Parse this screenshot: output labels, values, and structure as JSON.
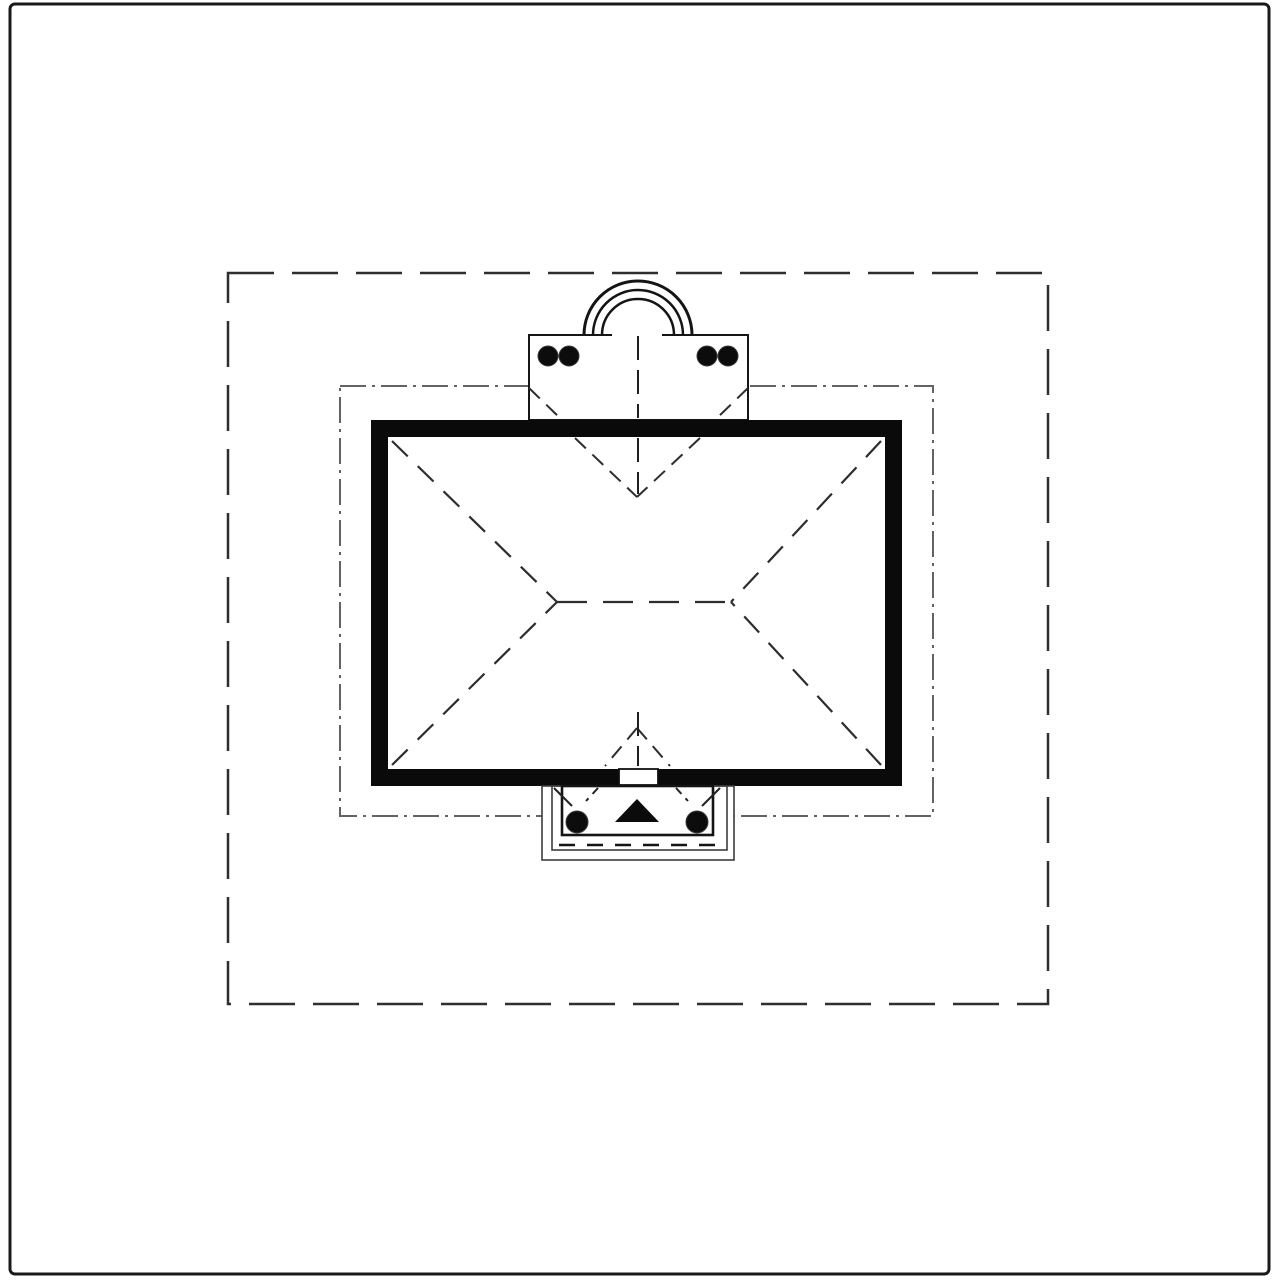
{
  "drawing": {
    "width": 1280,
    "height": 1280,
    "background": "#ffffff",
    "palette": {
      "ink": "#0a0a0a",
      "line_dark": "#1a1a1a",
      "roofline_gray": "#2d2d2d",
      "setback_gray": "#636363",
      "boundary_gray": "#2e2e2e",
      "white": "#ffffff"
    },
    "shapes": [
      {
        "name": "page-border",
        "type": "rect",
        "attrs": {
          "x": 10,
          "y": 4,
          "width": 1259,
          "height": 1270,
          "rx": 5,
          "fill": "none",
          "stroke": "#1a1a1a",
          "stroke-width": 3
        }
      },
      {
        "name": "property-boundary-dashed",
        "type": "rect",
        "attrs": {
          "x": 228,
          "y": 273,
          "width": 820,
          "height": 731,
          "fill": "none",
          "stroke": "#2e2e2e",
          "stroke-width": 2.5,
          "stroke-dasharray": "46 18"
        }
      },
      {
        "name": "setback-line-dashed",
        "type": "rect",
        "attrs": {
          "x": 340,
          "y": 386,
          "width": 593,
          "height": 430,
          "fill": "none",
          "stroke": "#636363",
          "stroke-width": 2,
          "stroke-dasharray": "26 6 3 6"
        }
      },
      {
        "name": "portico-slab",
        "type": "rect",
        "attrs": {
          "x": 529,
          "y": 335,
          "width": 219,
          "height": 85,
          "fill": "#ffffff",
          "stroke": "#161616",
          "stroke-width": 2
        }
      },
      {
        "name": "portico-entry-gap",
        "type": "rect",
        "attrs": {
          "x": 612,
          "y": 331,
          "width": 50,
          "height": 8,
          "fill": "#ffffff",
          "stroke": "none"
        }
      },
      {
        "name": "portico-arch-outer-icon",
        "type": "path",
        "attrs": {
          "d": "M 584 335 A 54 54 0 0 1 692 335",
          "fill": "none",
          "stroke": "#141414",
          "stroke-width": 3
        }
      },
      {
        "name": "portico-arch-middle-icon",
        "type": "path",
        "attrs": {
          "d": "M 593 335 A 45 45 0 0 1 683 335",
          "fill": "none",
          "stroke": "#141414",
          "stroke-width": 2.5
        }
      },
      {
        "name": "portico-arch-inner-icon",
        "type": "path",
        "attrs": {
          "d": "M 602 335 A 36 36 0 0 1 674 335",
          "fill": "none",
          "stroke": "#141414",
          "stroke-width": 2.5
        }
      },
      {
        "name": "portico-column-1",
        "type": "circle",
        "attrs": {
          "cx": 548,
          "cy": 356,
          "r": 10,
          "fill": "#0c0c0c",
          "stroke": "#3a3a3a",
          "stroke-width": 1
        }
      },
      {
        "name": "portico-column-2",
        "type": "circle",
        "attrs": {
          "cx": 569,
          "cy": 356,
          "r": 10,
          "fill": "#0c0c0c",
          "stroke": "#3a3a3a",
          "stroke-width": 1
        }
      },
      {
        "name": "portico-column-3",
        "type": "circle",
        "attrs": {
          "cx": 707,
          "cy": 356,
          "r": 10,
          "fill": "#0c0c0c",
          "stroke": "#3a3a3a",
          "stroke-width": 1
        }
      },
      {
        "name": "portico-column-4",
        "type": "circle",
        "attrs": {
          "cx": 728,
          "cy": 356,
          "r": 10,
          "fill": "#0c0c0c",
          "stroke": "#3a3a3a",
          "stroke-width": 1
        }
      },
      {
        "name": "building-wall",
        "type": "rect",
        "attrs": {
          "x": 371,
          "y": 420,
          "width": 531,
          "height": 366,
          "fill": "#0a0a0a"
        }
      },
      {
        "name": "roof-plane",
        "type": "rect",
        "attrs": {
          "x": 388,
          "y": 437,
          "width": 497,
          "height": 332,
          "fill": "#ffffff"
        }
      },
      {
        "name": "roof-ridge",
        "type": "line",
        "attrs": {
          "x1": 557,
          "y1": 602,
          "x2": 731,
          "y2": 602,
          "stroke": "#2d2d2d",
          "stroke-width": 2.2,
          "stroke-dasharray": "30 16"
        }
      },
      {
        "name": "roof-hip-nw",
        "type": "line",
        "attrs": {
          "x1": 392,
          "y1": 441,
          "x2": 557,
          "y2": 602,
          "stroke": "#2d2d2d",
          "stroke-width": 2.2,
          "stroke-dasharray": "22 14"
        }
      },
      {
        "name": "roof-hip-sw",
        "type": "line",
        "attrs": {
          "x1": 392,
          "y1": 765,
          "x2": 557,
          "y2": 602,
          "stroke": "#2d2d2d",
          "stroke-width": 2.2,
          "stroke-dasharray": "22 14"
        }
      },
      {
        "name": "roof-hip-ne",
        "type": "line",
        "attrs": {
          "x1": 881,
          "y1": 441,
          "x2": 731,
          "y2": 602,
          "stroke": "#2d2d2d",
          "stroke-width": 2.2,
          "stroke-dasharray": "22 14"
        }
      },
      {
        "name": "roof-hip-se",
        "type": "line",
        "attrs": {
          "x1": 881,
          "y1": 765,
          "x2": 731,
          "y2": 602,
          "stroke": "#2d2d2d",
          "stroke-width": 2.2,
          "stroke-dasharray": "22 14"
        }
      },
      {
        "name": "roof-valley-front-left",
        "type": "line",
        "attrs": {
          "x1": 575,
          "y1": 438,
          "x2": 637,
          "y2": 497,
          "stroke": "#2d2d2d",
          "stroke-width": 2,
          "stroke-dasharray": "15 9"
        }
      },
      {
        "name": "roof-valley-front-right",
        "type": "line",
        "attrs": {
          "x1": 700,
          "y1": 438,
          "x2": 637,
          "y2": 497,
          "stroke": "#2d2d2d",
          "stroke-width": 2,
          "stroke-dasharray": "15 9"
        }
      },
      {
        "name": "portico-valley-left",
        "type": "line",
        "attrs": {
          "x1": 529,
          "y1": 388,
          "x2": 561,
          "y2": 419,
          "stroke": "#2d2d2d",
          "stroke-width": 2,
          "stroke-dasharray": "15 9"
        }
      },
      {
        "name": "portico-valley-right",
        "type": "line",
        "attrs": {
          "x1": 748,
          "y1": 388,
          "x2": 716,
          "y2": 419,
          "stroke": "#2d2d2d",
          "stroke-width": 2,
          "stroke-dasharray": "15 9"
        }
      },
      {
        "name": "roof-valley-rear-left",
        "type": "line",
        "attrs": {
          "x1": 637,
          "y1": 728,
          "x2": 605,
          "y2": 766,
          "stroke": "#2d2d2d",
          "stroke-width": 2,
          "stroke-dasharray": "15 9"
        }
      },
      {
        "name": "roof-valley-rear-right",
        "type": "line",
        "attrs": {
          "x1": 637,
          "y1": 728,
          "x2": 670,
          "y2": 766,
          "stroke": "#2d2d2d",
          "stroke-width": 2,
          "stroke-dasharray": "15 9"
        }
      },
      {
        "name": "centerline-front-upper",
        "type": "line",
        "attrs": {
          "x1": 638,
          "y1": 336,
          "x2": 638,
          "y2": 418,
          "stroke": "#1f1f1f",
          "stroke-width": 2,
          "stroke-dasharray": "24 10"
        }
      },
      {
        "name": "centerline-front-lower",
        "type": "line",
        "attrs": {
          "x1": 638,
          "y1": 438,
          "x2": 638,
          "y2": 494,
          "stroke": "#1f1f1f",
          "stroke-width": 2,
          "stroke-dasharray": "24 10"
        }
      },
      {
        "name": "centerline-rear-upper",
        "type": "line",
        "attrs": {
          "x1": 638,
          "y1": 712,
          "x2": 638,
          "y2": 766,
          "stroke": "#1f1f1f",
          "stroke-width": 2,
          "stroke-dasharray": "24 10"
        }
      },
      {
        "name": "centerline-rear-lower",
        "type": "line",
        "attrs": {
          "x1": 638,
          "y1": 788,
          "x2": 638,
          "y2": 858,
          "stroke": "#1f1f1f",
          "stroke-width": 2,
          "stroke-dasharray": "24 10"
        }
      },
      {
        "name": "door-opening",
        "type": "rect",
        "attrs": {
          "x": 619,
          "y": 769,
          "width": 39,
          "height": 16,
          "fill": "#ffffff",
          "stroke": "#111111",
          "stroke-width": 1.8
        }
      },
      {
        "name": "stoop-outer-edge",
        "type": "rect",
        "attrs": {
          "x": 542,
          "y": 786,
          "width": 192,
          "height": 74,
          "fill": "#ffffff",
          "stroke": "#3c3c3c",
          "stroke-width": 1.6
        }
      },
      {
        "name": "stoop-middle-edge",
        "type": "rect",
        "attrs": {
          "x": 552,
          "y": 786,
          "width": 175,
          "height": 64,
          "fill": "none",
          "stroke": "#3c3c3c",
          "stroke-width": 1.6
        }
      },
      {
        "name": "stoop-inner-edge",
        "type": "rect",
        "attrs": {
          "x": 562,
          "y": 786,
          "width": 151,
          "height": 49,
          "fill": "none",
          "stroke": "#141414",
          "stroke-width": 2.6
        }
      },
      {
        "name": "stoop-step-dashed-line",
        "type": "line",
        "attrs": {
          "x1": 559,
          "y1": 845,
          "x2": 722,
          "y2": 845,
          "stroke": "#141414",
          "stroke-width": 2.4,
          "stroke-dasharray": "16 12"
        }
      },
      {
        "name": "stoop-valley-left-solid",
        "type": "line",
        "attrs": {
          "x1": 554,
          "y1": 788,
          "x2": 572,
          "y2": 806,
          "stroke": "#222222",
          "stroke-width": 2
        }
      },
      {
        "name": "stoop-valley-right-solid",
        "type": "line",
        "attrs": {
          "x1": 720,
          "y1": 788,
          "x2": 702,
          "y2": 806,
          "stroke": "#222222",
          "stroke-width": 2
        }
      },
      {
        "name": "stoop-valley-left-dashed",
        "type": "line",
        "attrs": {
          "x1": 598,
          "y1": 788,
          "x2": 586,
          "y2": 801,
          "stroke": "#222222",
          "stroke-width": 2,
          "stroke-dasharray": "8 6"
        }
      },
      {
        "name": "stoop-valley-right-dashed",
        "type": "line",
        "attrs": {
          "x1": 676,
          "y1": 788,
          "x2": 688,
          "y2": 801,
          "stroke": "#222222",
          "stroke-width": 2,
          "stroke-dasharray": "8 6"
        }
      },
      {
        "name": "stoop-column-left",
        "type": "circle",
        "attrs": {
          "cx": 577,
          "cy": 822,
          "r": 11,
          "fill": "#0c0c0c",
          "stroke": "#3a3a3a",
          "stroke-width": 1
        }
      },
      {
        "name": "stoop-column-right",
        "type": "circle",
        "attrs": {
          "cx": 697,
          "cy": 822,
          "r": 11,
          "fill": "#0c0c0c",
          "stroke": "#3a3a3a",
          "stroke-width": 1
        }
      },
      {
        "name": "entry-direction-arrow-icon",
        "type": "polygon",
        "attrs": {
          "points": "637,799 615,822 659,822",
          "fill": "#0b0b0b"
        }
      }
    ]
  }
}
